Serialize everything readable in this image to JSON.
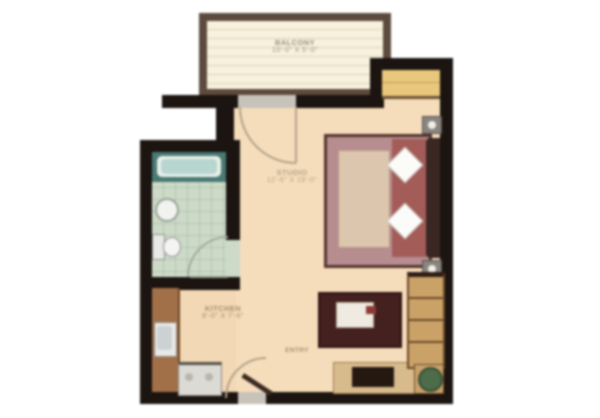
{
  "plan": {
    "type": "apartment-floor-plan",
    "rooms": {
      "balcony": {
        "name": "BALCONY",
        "dimensions": "10'-0\" X 5'-0\""
      },
      "studio": {
        "name": "STUDIO",
        "dimensions": "12'-6\" X 19'-0\""
      },
      "kitchen": {
        "name": "KITCHEN",
        "dimensions": "8'-0\" X 7'-6\""
      },
      "entry": {
        "name": "ENTRY"
      },
      "bathroom": {
        "name": ""
      }
    },
    "colors": {
      "wall": "#1b1410",
      "floor_main": "#f5ddbb",
      "floor_bathroom": "#cddac8",
      "balcony_frame": "#5d4a3e",
      "balcony_floor": "#f7f1dd",
      "closet": "#e9c77d",
      "bed_blanket": "#b78d90",
      "bed_sheets": "#a35c58",
      "bed_frame": "#54352e",
      "table": "#44201f",
      "cabinet": "#d8bb8d",
      "counter": "#a27048",
      "tub": "#497a74",
      "door_arc": "#b3a289",
      "label_text": "#b59f83"
    }
  }
}
